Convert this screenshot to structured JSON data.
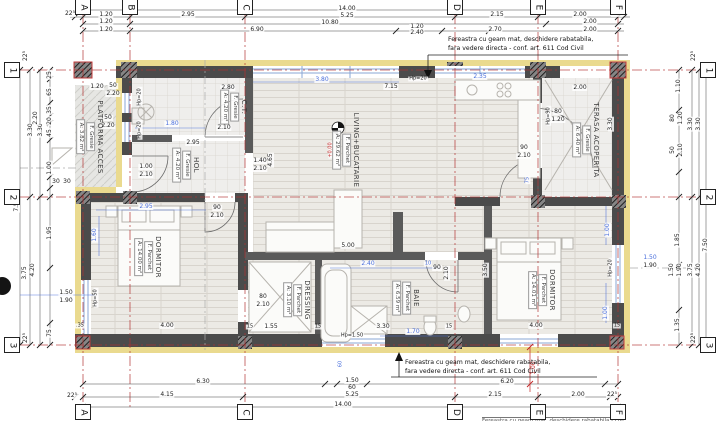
{
  "drawing_type": "architectural floor plan",
  "colors": {
    "grid_red": "#b23030",
    "dim_blue": "#4a6fdc",
    "note_red": "#c22525",
    "wall": "#4b4b4b",
    "insulation": "#eada8f"
  },
  "notes": {
    "top_l1": "Fereastra cu geam mat, deschidere rabatabila,",
    "top_l2": "fara vedere directa - conf. art. 611 Cod Civil",
    "bottom_l1": "Fereastra cu geam mat, deschidere rabatabila,",
    "bottom_l2": "fara vedere directa - conf. art. 611 Cod Civil",
    "partial": "Fereastra cu geam mat, deschidere rabatabila - conf. art. 611 Cod Civil"
  },
  "grid": {
    "top": [
      {
        "label": "A",
        "x": 83
      },
      {
        "label": "B",
        "x": 130
      },
      {
        "label": "C",
        "x": 245
      },
      {
        "label": "D",
        "x": 455
      },
      {
        "label": "E",
        "x": 538
      },
      {
        "label": "F",
        "x": 618
      }
    ],
    "bottom": [
      {
        "label": "A",
        "x": 83
      },
      {
        "label": "C",
        "x": 245
      },
      {
        "label": "D",
        "x": 455
      },
      {
        "label": "E",
        "x": 538
      },
      {
        "label": "F",
        "x": 618
      }
    ],
    "left": [
      {
        "label": "1",
        "y": 70
      },
      {
        "label": "2",
        "y": 197
      },
      {
        "label": "3",
        "y": 345
      }
    ],
    "right": [
      {
        "label": "1",
        "y": 70
      },
      {
        "label": "2",
        "y": 197
      },
      {
        "label": "3",
        "y": 345
      }
    ]
  },
  "rooms": [
    {
      "name": "PLATFORMA ACCES",
      "finish": "F. Gresie",
      "area": "A: 3.82 m²",
      "x": 90,
      "y": 137
    },
    {
      "name": "C.T.",
      "finish": "F. Gresie",
      "area": "A: 4.20 m²",
      "x": 234,
      "y": 107
    },
    {
      "name": "HOL",
      "finish": "F. Gresie",
      "area": "A: 4.20 m²",
      "x": 186,
      "y": 165
    },
    {
      "name": "LIVING+BUCATARIE",
      "finish": "F. Parchet",
      "area": "A: 29.62 m²",
      "x": 346,
      "y": 150
    },
    {
      "name": "TERASA ACOPERITA",
      "finish": "F. Gresie",
      "area": "A: 6.40 m²",
      "x": 586,
      "y": 140
    },
    {
      "name": "DORMITOR",
      "finish": "F. Parchet",
      "area": "A: 14.00 m²",
      "x": 148,
      "y": 257
    },
    {
      "name": "DRESSING",
      "finish": "F. Parchet",
      "area": "A: 3.10 m²",
      "x": 297,
      "y": 300
    },
    {
      "name": "BAIE",
      "finish": "F. Parchet",
      "area": "A: 6.59 m²",
      "x": 406,
      "y": 298
    },
    {
      "name": "DORMITOR",
      "finish": "F. Parchet",
      "area": "A: 14.01 m²",
      "x": 542,
      "y": 290
    }
  ],
  "dim_labels": [
    {
      "t": "14.00",
      "x": 347,
      "y": 9
    },
    {
      "t": "5.25",
      "x": 347,
      "y": 16
    },
    {
      "t": "10.80",
      "x": 330,
      "y": 23
    },
    {
      "t": "6.90",
      "x": 257,
      "y": 30
    },
    {
      "t": "22⁵",
      "x": 70,
      "y": 14
    },
    {
      "t": "1.20",
      "x": 106,
      "y": 15
    },
    {
      "t": "2.95",
      "x": 188,
      "y": 15
    },
    {
      "t": "2.15",
      "x": 497,
      "y": 15
    },
    {
      "t": "2.00",
      "x": 580,
      "y": 15
    },
    {
      "t": "22⁵",
      "x": 617,
      "y": 14
    },
    {
      "t": "1.20",
      "x": 106,
      "y": 22
    },
    {
      "t": "2.00",
      "x": 590,
      "y": 22
    },
    {
      "t": "1.20",
      "x": 106,
      "y": 30
    },
    {
      "t": "1.20",
      "x": 417,
      "y": 27
    },
    {
      "t": "2.40",
      "x": 417,
      "y": 33
    },
    {
      "t": "2.70",
      "x": 495,
      "y": 30
    },
    {
      "t": "2.00",
      "x": 590,
      "y": 30
    },
    {
      "t": "6.30",
      "x": 203,
      "y": 382
    },
    {
      "t": "1.50",
      "x": 352,
      "y": 381
    },
    {
      "t": "60",
      "x": 352,
      "y": 388
    },
    {
      "t": "6.20",
      "x": 507,
      "y": 382
    },
    {
      "t": "4.15",
      "x": 167,
      "y": 395
    },
    {
      "t": "5.25",
      "x": 352,
      "y": 395
    },
    {
      "t": "2.15",
      "x": 495,
      "y": 395
    },
    {
      "t": "2.00",
      "x": 578,
      "y": 395
    },
    {
      "t": "22⁵",
      "x": 72,
      "y": 396
    },
    {
      "t": "22⁵",
      "x": 612,
      "y": 395
    },
    {
      "t": "14.00",
      "x": 343,
      "y": 405
    },
    {
      "t": "1.00",
      "x": 534,
      "y": 368,
      "r": 1,
      "c": "r"
    },
    {
      "t": "22⁵",
      "x": 26,
      "y": 56,
      "r": 1
    },
    {
      "t": "7.50",
      "x": 17,
      "y": 205,
      "r": 1
    },
    {
      "t": "3.30",
      "x": 31,
      "y": 130,
      "r": 1
    },
    {
      "t": "3.30",
      "x": 41,
      "y": 130,
      "r": 1
    },
    {
      "t": "2.20",
      "x": 36,
      "y": 118,
      "r": 1
    },
    {
      "t": "25",
      "x": 50,
      "y": 75,
      "r": 1
    },
    {
      "t": "65",
      "x": 50,
      "y": 92,
      "r": 1
    },
    {
      "t": "35",
      "x": 50,
      "y": 110,
      "r": 1
    },
    {
      "t": "20",
      "x": 50,
      "y": 121,
      "r": 1
    },
    {
      "t": "45",
      "x": 50,
      "y": 133,
      "r": 1
    },
    {
      "t": "1.00",
      "x": 50,
      "y": 168,
      "r": 1
    },
    {
      "t": "30",
      "x": 56,
      "y": 182
    },
    {
      "t": "30",
      "x": 67,
      "y": 182
    },
    {
      "t": "1.95",
      "x": 50,
      "y": 233,
      "r": 1
    },
    {
      "t": "4.20",
      "x": 33,
      "y": 270,
      "r": 1
    },
    {
      "t": "3.75",
      "x": 25,
      "y": 273,
      "r": 1
    },
    {
      "t": "75",
      "x": 50,
      "y": 333,
      "r": 1
    },
    {
      "t": "22⁵",
      "x": 26,
      "y": 338,
      "r": 1
    },
    {
      "t": "1.50",
      "x": 66,
      "y": 293
    },
    {
      "t": "1.90",
      "x": 66,
      "y": 301
    },
    {
      "t": "22⁵",
      "x": 694,
      "y": 56,
      "r": 1
    },
    {
      "t": "1.10",
      "x": 679,
      "y": 86,
      "r": 1
    },
    {
      "t": "80",
      "x": 673,
      "y": 118,
      "r": 1
    },
    {
      "t": "1.20",
      "x": 681,
      "y": 118,
      "r": 1
    },
    {
      "t": "50",
      "x": 673,
      "y": 150,
      "r": 1
    },
    {
      "t": "2.10",
      "x": 681,
      "y": 150,
      "r": 1
    },
    {
      "t": "3.30",
      "x": 691,
      "y": 124,
      "r": 1
    },
    {
      "t": "3.30",
      "x": 699,
      "y": 124,
      "r": 1
    },
    {
      "t": "1.85",
      "x": 678,
      "y": 240,
      "r": 1
    },
    {
      "t": "7.50",
      "x": 706,
      "y": 245,
      "r": 1
    },
    {
      "t": "1.50",
      "x": 672,
      "y": 270,
      "r": 1
    },
    {
      "t": "1.90",
      "x": 680,
      "y": 270,
      "r": 1
    },
    {
      "t": "3.75",
      "x": 691,
      "y": 270,
      "r": 1
    },
    {
      "t": "4.20",
      "x": 699,
      "y": 270,
      "r": 1
    },
    {
      "t": "1.35",
      "x": 678,
      "y": 325,
      "r": 1
    },
    {
      "t": "22⁵",
      "x": 694,
      "y": 338,
      "r": 1
    },
    {
      "t": "1.50",
      "x": 650,
      "y": 258,
      "c": "b"
    },
    {
      "t": "1.90",
      "x": 650,
      "y": 266
    },
    {
      "t": "1.20",
      "x": 97,
      "y": 87
    },
    {
      "t": "50",
      "x": 113,
      "y": 86
    },
    {
      "t": "2.20",
      "x": 113,
      "y": 94
    },
    {
      "t": "50",
      "x": 108,
      "y": 118
    },
    {
      "t": "2.20",
      "x": 108,
      "y": 126
    },
    {
      "t": "Hp=20",
      "x": 140,
      "y": 97,
      "r": 1,
      "fs": 5
    },
    {
      "t": "Hp=20",
      "x": 140,
      "y": 130,
      "r": 1,
      "fs": 5
    },
    {
      "t": "2.80",
      "x": 228,
      "y": 88
    },
    {
      "t": "1.80",
      "x": 172,
      "y": 124,
      "c": "b"
    },
    {
      "t": "90",
      "x": 224,
      "y": 120
    },
    {
      "t": "2.10",
      "x": 224,
      "y": 128
    },
    {
      "t": "2.95",
      "x": 193,
      "y": 143
    },
    {
      "t": "1.00",
      "x": 146,
      "y": 167
    },
    {
      "t": "2.10",
      "x": 146,
      "y": 175
    },
    {
      "t": "1.40",
      "x": 260,
      "y": 161
    },
    {
      "t": "2.10",
      "x": 260,
      "y": 169
    },
    {
      "t": "4.65",
      "x": 271,
      "y": 160,
      "r": 1
    },
    {
      "t": "3.80",
      "x": 322,
      "y": 80,
      "c": "b"
    },
    {
      "t": "7.15",
      "x": 391,
      "y": 87
    },
    {
      "t": "Hp=20",
      "x": 418,
      "y": 79,
      "fs": 5
    },
    {
      "t": "2.35",
      "x": 480,
      "y": 77,
      "c": "b"
    },
    {
      "t": "Hp=90",
      "x": 549,
      "y": 116,
      "r": 1,
      "fs": 5
    },
    {
      "t": "80",
      "x": 558,
      "y": 112
    },
    {
      "t": "1.20",
      "x": 558,
      "y": 120
    },
    {
      "t": "2.00",
      "x": 580,
      "y": 88
    },
    {
      "t": "+0.00",
      "x": 331,
      "y": 150,
      "r": 1,
      "c": "r",
      "fs": 5
    },
    {
      "t": "5.00",
      "x": 348,
      "y": 246
    },
    {
      "t": "2.40",
      "x": 368,
      "y": 264,
      "c": "b"
    },
    {
      "t": "10",
      "x": 428,
      "y": 264,
      "c": "b",
      "fs": 5
    },
    {
      "t": "90",
      "x": 437,
      "y": 268
    },
    {
      "t": "2.10",
      "x": 447,
      "y": 273,
      "r": 1
    },
    {
      "t": "3.50",
      "x": 486,
      "y": 270,
      "r": 1
    },
    {
      "t": "2.95",
      "x": 146,
      "y": 207,
      "c": "b"
    },
    {
      "t": "1.60",
      "x": 95,
      "y": 235,
      "r": 1,
      "c": "b"
    },
    {
      "t": "90",
      "x": 217,
      "y": 208
    },
    {
      "t": "2.10",
      "x": 217,
      "y": 216
    },
    {
      "t": "Hp=50",
      "x": 96,
      "y": 298,
      "r": 1,
      "fs": 5
    },
    {
      "t": ".35",
      "x": 80,
      "y": 326,
      "fs": 5
    },
    {
      "t": "4.00",
      "x": 167,
      "y": 326
    },
    {
      "t": "80",
      "x": 263,
      "y": 297
    },
    {
      "t": "2.10",
      "x": 263,
      "y": 305
    },
    {
      "t": "1.55",
      "x": 271,
      "y": 327
    },
    {
      "t": "3.30",
      "x": 383,
      "y": 327
    },
    {
      "t": "1.70",
      "x": 413,
      "y": 332,
      "c": "b"
    },
    {
      "t": "Hp=1.50",
      "x": 352,
      "y": 336,
      "fs": 5
    },
    {
      "t": "60",
      "x": 341,
      "y": 364,
      "r": 1,
      "c": "b",
      "fs": 5
    },
    {
      "t": "90",
      "x": 524,
      "y": 148
    },
    {
      "t": "2.10",
      "x": 524,
      "y": 156
    },
    {
      "t": "75",
      "x": 528,
      "y": 180,
      "r": 1,
      "c": "b",
      "fs": 5
    },
    {
      "t": "1.00",
      "x": 608,
      "y": 230,
      "r": 1,
      "c": "b"
    },
    {
      "t": "1.00",
      "x": 606,
      "y": 313,
      "r": 1,
      "c": "b"
    },
    {
      "t": "Hp=20",
      "x": 611,
      "y": 268,
      "r": 1,
      "fs": 5
    },
    {
      "t": "4.00",
      "x": 536,
      "y": 326
    },
    {
      "t": "3.30",
      "x": 611,
      "y": 124,
      "r": 1
    },
    {
      "t": "15",
      "x": 250,
      "y": 327,
      "fs": 5
    },
    {
      "t": "15",
      "x": 318,
      "y": 327,
      "fs": 5
    },
    {
      "t": "15",
      "x": 449,
      "y": 327,
      "fs": 5
    },
    {
      "t": "15",
      "x": 617,
      "y": 326,
      "fs": 5
    }
  ]
}
